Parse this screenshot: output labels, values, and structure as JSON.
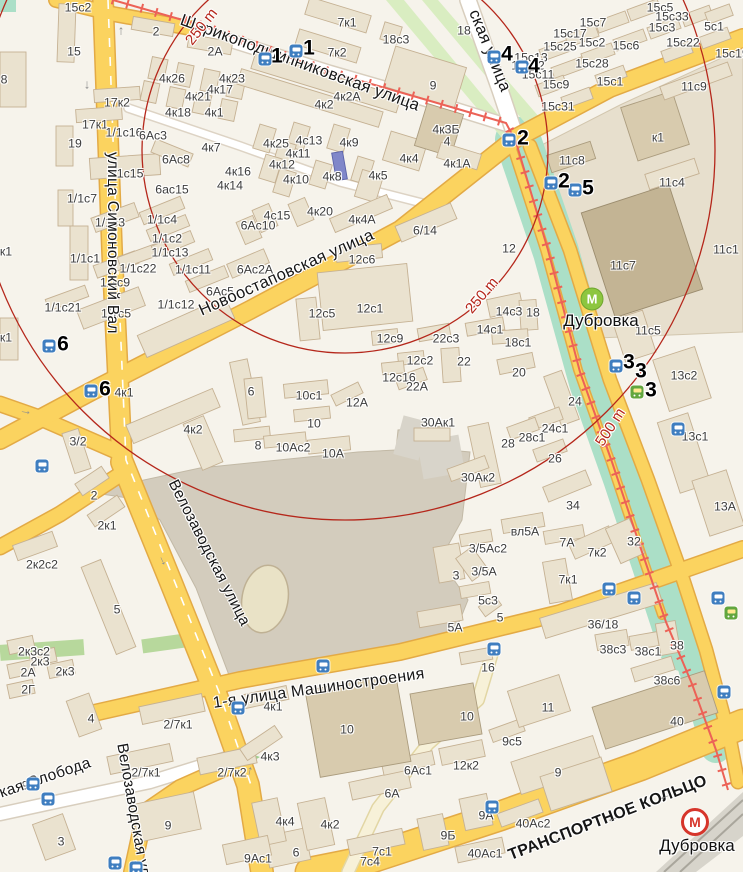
{
  "map_title": "Дубровка район — карта",
  "colors": {
    "bg": "#f6f3eb",
    "ring": "#b5271b",
    "road": "#fbd35f",
    "roadCase": "#e3aa45",
    "white": "#ffffff",
    "whiteCase": "#d8cebe",
    "green": "#abdfc7",
    "paleGreen": "#d9edc1",
    "stadium": "#d3ccbd",
    "oval": "#e9e2c6",
    "bld": "#eae2cf",
    "bldStroke": "#c5b193",
    "bldDark": "#d8cbae",
    "bldDarker": "#c3b494",
    "tram": "#ec6257",
    "bus": "#3f7ec0",
    "tramStop": "#62a63e",
    "metroGreen": "#8dc63f",
    "metroRed": "#d6352b",
    "ramp": "#f7f1d8",
    "rampCase": "#e2d6a4"
  },
  "rings": {
    "labels": [
      {
        "t": "250 m",
        "x": 182,
        "y": 38,
        "r": -52
      },
      {
        "t": "250 m",
        "x": 462,
        "y": 306,
        "r": -50
      },
      {
        "t": "500 m",
        "x": 592,
        "y": 440,
        "r": -57
      }
    ]
  },
  "streets": [
    {
      "t": "улица Симоновский Вал",
      "x": 121,
      "y": 152,
      "r": 90,
      "s": 15.5
    },
    {
      "t": "Велозаводская улица",
      "x": 180,
      "y": 477,
      "r": 63,
      "s": 15.5
    },
    {
      "t": "Велозаводская улица",
      "x": 130,
      "y": 742,
      "r": 80,
      "s": 15.5
    },
    {
      "t": "Новоостаповская улица",
      "x": 196,
      "y": 303,
      "r": -24,
      "s": 16.5
    },
    {
      "t": "Шарикоподшипниковская улица",
      "x": 184,
      "y": 11,
      "r": 20,
      "s": 16.5
    },
    {
      "t": "ская улица",
      "x": 482,
      "y": 7,
      "r": 68,
      "s": 16.5
    },
    {
      "t": "1-я улица Машиностроения",
      "x": 212,
      "y": 695,
      "r": -8,
      "s": 16
    },
    {
      "t": "Ленинская Слобода",
      "x": -54,
      "y": 803,
      "r": -19,
      "s": 15.5
    },
    {
      "t": "ТРАНСПОРТНОЕ КОЛЬЦО",
      "x": 506,
      "y": 848,
      "r": -21,
      "s": 16,
      "w": 600
    }
  ],
  "metro_stations": [
    {
      "name": "Дубровка",
      "kind": "green",
      "x": 592,
      "y": 299,
      "lx": 601,
      "ly": 311
    },
    {
      "name": "Дубровка",
      "kind": "red",
      "x": 695,
      "y": 822,
      "lx": 697,
      "ly": 836
    }
  ],
  "markers": [
    {
      "n": "1",
      "x": 277,
      "y": 57
    },
    {
      "n": "1",
      "x": 309,
      "y": 49
    },
    {
      "n": "4",
      "x": 507,
      "y": 55
    },
    {
      "n": "4",
      "x": 534,
      "y": 67
    },
    {
      "n": "2",
      "x": 523,
      "y": 139
    },
    {
      "n": "2",
      "x": 564,
      "y": 182
    },
    {
      "n": "5",
      "x": 588,
      "y": 189
    },
    {
      "n": "6",
      "x": 63,
      "y": 345
    },
    {
      "n": "6",
      "x": 105,
      "y": 390
    },
    {
      "n": "3",
      "x": 629,
      "y": 363
    },
    {
      "n": "3",
      "x": 641,
      "y": 372
    },
    {
      "n": "3",
      "x": 651,
      "y": 391
    }
  ],
  "bus_stops": [
    {
      "x": 265,
      "y": 59
    },
    {
      "x": 296,
      "y": 51
    },
    {
      "x": 494,
      "y": 57
    },
    {
      "x": 522,
      "y": 67
    },
    {
      "x": 509,
      "y": 140
    },
    {
      "x": 551,
      "y": 183
    },
    {
      "x": 575,
      "y": 190
    },
    {
      "x": 49,
      "y": 346
    },
    {
      "x": 91,
      "y": 391
    },
    {
      "x": 616,
      "y": 366
    },
    {
      "x": 678,
      "y": 429
    },
    {
      "x": 42,
      "y": 466
    },
    {
      "x": 33,
      "y": 784
    },
    {
      "x": 48,
      "y": 799
    },
    {
      "x": 115,
      "y": 863
    },
    {
      "x": 136,
      "y": 868
    },
    {
      "x": 238,
      "y": 708
    },
    {
      "x": 323,
      "y": 666
    },
    {
      "x": 494,
      "y": 649
    },
    {
      "x": 609,
      "y": 589
    },
    {
      "x": 634,
      "y": 598
    },
    {
      "x": 718,
      "y": 598
    },
    {
      "x": 724,
      "y": 692
    },
    {
      "x": 492,
      "y": 807
    }
  ],
  "tram_stops": [
    {
      "x": 637,
      "y": 392
    },
    {
      "x": 731,
      "y": 613
    }
  ],
  "road_arrows": [
    {
      "g": "↑",
      "x": 121,
      "y": 30,
      "r": 0
    },
    {
      "g": "↓",
      "x": 87,
      "y": 84,
      "r": 0
    },
    {
      "g": "↓",
      "x": 162,
      "y": 560,
      "r": -25
    },
    {
      "g": "→",
      "x": 26,
      "y": 410,
      "r": 10
    },
    {
      "g": "←",
      "x": 558,
      "y": 838,
      "r": -21
    },
    {
      "g": "←",
      "x": 612,
      "y": 817,
      "r": -21
    },
    {
      "g": "←",
      "x": 664,
      "y": 795,
      "r": -21
    },
    {
      "g": "↑",
      "x": 250,
      "y": 770,
      "r": 12
    }
  ],
  "buildings": [
    {
      "t": "15с2",
      "x": 78,
      "y": 8
    },
    {
      "t": "15",
      "x": 74,
      "y": 52
    },
    {
      "t": "2",
      "x": 156,
      "y": 32
    },
    {
      "t": "8",
      "x": 4,
      "y": 80
    },
    {
      "t": "2А",
      "x": 215,
      "y": 52
    },
    {
      "t": "4к26",
      "x": 172,
      "y": 79
    },
    {
      "t": "4к23",
      "x": 232,
      "y": 79
    },
    {
      "t": "4к17",
      "x": 220,
      "y": 90
    },
    {
      "t": "4к21",
      "x": 198,
      "y": 97
    },
    {
      "t": "4к18",
      "x": 178,
      "y": 113
    },
    {
      "t": "4к1",
      "x": 214,
      "y": 113
    },
    {
      "t": "17к2",
      "x": 117,
      "y": 103
    },
    {
      "t": "17к1",
      "x": 95,
      "y": 125
    },
    {
      "t": "1/1с16",
      "x": 124,
      "y": 133
    },
    {
      "t": "6Ас3",
      "x": 153,
      "y": 136
    },
    {
      "t": "19",
      "x": 75,
      "y": 144
    },
    {
      "t": "4к7",
      "x": 211,
      "y": 148
    },
    {
      "t": "6Ас8",
      "x": 176,
      "y": 160
    },
    {
      "t": "1/1с15",
      "x": 125,
      "y": 174
    },
    {
      "t": "6ас15",
      "x": 172,
      "y": 190
    },
    {
      "t": "4к16",
      "x": 238,
      "y": 172
    },
    {
      "t": "4к14",
      "x": 230,
      "y": 186
    },
    {
      "t": "к1",
      "x": 6,
      "y": 252
    },
    {
      "t": "к1",
      "x": 6,
      "y": 338
    },
    {
      "t": "1/1с7",
      "x": 82,
      "y": 199
    },
    {
      "t": "1/1с3",
      "x": 110,
      "y": 223
    },
    {
      "t": "1/1с4",
      "x": 162,
      "y": 220
    },
    {
      "t": "1/1с2",
      "x": 167,
      "y": 239
    },
    {
      "t": "1/1с13",
      "x": 170,
      "y": 253
    },
    {
      "t": "1/1с1",
      "x": 85,
      "y": 259
    },
    {
      "t": "1/1с22",
      "x": 138,
      "y": 269
    },
    {
      "t": "1/1с11",
      "x": 193,
      "y": 270
    },
    {
      "t": "1/1с9",
      "x": 115,
      "y": 283
    },
    {
      "t": "6Ас5",
      "x": 220,
      "y": 292
    },
    {
      "t": "1/1с21",
      "x": 63,
      "y": 308
    },
    {
      "t": "1/1с5",
      "x": 116,
      "y": 314
    },
    {
      "t": "1/1с12",
      "x": 176,
      "y": 305
    },
    {
      "t": "6",
      "x": 251,
      "y": 392
    },
    {
      "t": "3/2",
      "x": 78,
      "y": 442
    },
    {
      "t": "2",
      "x": 94,
      "y": 496
    },
    {
      "t": "2к1",
      "x": 107,
      "y": 526
    },
    {
      "t": "2к2с2",
      "x": 42,
      "y": 565
    },
    {
      "t": "5",
      "x": 117,
      "y": 610
    },
    {
      "t": "4к2",
      "x": 193,
      "y": 430
    },
    {
      "t": "7к1",
      "x": 347,
      "y": 23
    },
    {
      "t": "7к2",
      "x": 337,
      "y": 53
    },
    {
      "t": "18с3",
      "x": 396,
      "y": 40
    },
    {
      "t": "18",
      "x": 464,
      "y": 31
    },
    {
      "t": "9",
      "x": 433,
      "y": 86
    },
    {
      "t": "4к2А",
      "x": 347,
      "y": 97
    },
    {
      "t": "4к2",
      "x": 324,
      "y": 105
    },
    {
      "t": "4к25",
      "x": 276,
      "y": 144
    },
    {
      "t": "4с13",
      "x": 309,
      "y": 141
    },
    {
      "t": "4к9",
      "x": 349,
      "y": 143
    },
    {
      "t": "4к11",
      "x": 298,
      "y": 154
    },
    {
      "t": "4к12",
      "x": 282,
      "y": 165
    },
    {
      "t": "4к10",
      "x": 296,
      "y": 180
    },
    {
      "t": "4к8",
      "x": 332,
      "y": 177
    },
    {
      "t": "4к5",
      "x": 378,
      "y": 176
    },
    {
      "t": "4к4",
      "x": 409,
      "y": 159
    },
    {
      "t": "4к3Б",
      "x": 446,
      "y": 130
    },
    {
      "t": "4",
      "x": 447,
      "y": 142
    },
    {
      "t": "4к1А",
      "x": 457,
      "y": 164
    },
    {
      "t": "4к20",
      "x": 320,
      "y": 212
    },
    {
      "t": "4с15",
      "x": 277,
      "y": 216
    },
    {
      "t": "6Ас10",
      "x": 258,
      "y": 226
    },
    {
      "t": "6Ас2А",
      "x": 255,
      "y": 270
    },
    {
      "t": "4к4А",
      "x": 362,
      "y": 220
    },
    {
      "t": "6/14",
      "x": 425,
      "y": 231
    },
    {
      "t": "12с6",
      "x": 362,
      "y": 260
    },
    {
      "t": "12с1",
      "x": 370,
      "y": 309
    },
    {
      "t": "12с5",
      "x": 322,
      "y": 314
    },
    {
      "t": "12с9",
      "x": 390,
      "y": 339
    },
    {
      "t": "22с3",
      "x": 446,
      "y": 339
    },
    {
      "t": "12с2",
      "x": 420,
      "y": 361
    },
    {
      "t": "22",
      "x": 464,
      "y": 362
    },
    {
      "t": "12с16",
      "x": 399,
      "y": 378
    },
    {
      "t": "22А",
      "x": 417,
      "y": 387
    },
    {
      "t": "12",
      "x": 509,
      "y": 249
    },
    {
      "t": "14с3",
      "x": 509,
      "y": 312
    },
    {
      "t": "14с1",
      "x": 490,
      "y": 330
    },
    {
      "t": "18",
      "x": 533,
      "y": 313
    },
    {
      "t": "18с1",
      "x": 518,
      "y": 343
    },
    {
      "t": "20",
      "x": 519,
      "y": 373
    },
    {
      "t": "24",
      "x": 575,
      "y": 402
    },
    {
      "t": "24с1",
      "x": 555,
      "y": 429
    },
    {
      "t": "28с1",
      "x": 532,
      "y": 438
    },
    {
      "t": "28",
      "x": 508,
      "y": 444
    },
    {
      "t": "26",
      "x": 555,
      "y": 459
    },
    {
      "t": "34",
      "x": 573,
      "y": 506
    },
    {
      "t": "30Ак1",
      "x": 438,
      "y": 423
    },
    {
      "t": "30Ак2",
      "x": 478,
      "y": 478
    },
    {
      "t": "10с1",
      "x": 309,
      "y": 396
    },
    {
      "t": "12А",
      "x": 357,
      "y": 403
    },
    {
      "t": "10",
      "x": 314,
      "y": 424
    },
    {
      "t": "8",
      "x": 258,
      "y": 446
    },
    {
      "t": "10Ас2",
      "x": 293,
      "y": 448
    },
    {
      "t": "10А",
      "x": 333,
      "y": 454
    },
    {
      "t": "15с5",
      "x": 660,
      "y": 8
    },
    {
      "t": "15с33",
      "x": 672,
      "y": 17
    },
    {
      "t": "15с3",
      "x": 662,
      "y": 28
    },
    {
      "t": "5с1",
      "x": 714,
      "y": 27
    },
    {
      "t": "15с22",
      "x": 683,
      "y": 43
    },
    {
      "t": "15с6",
      "x": 626,
      "y": 46
    },
    {
      "t": "15с7",
      "x": 593,
      "y": 23
    },
    {
      "t": "15с17",
      "x": 570,
      "y": 34
    },
    {
      "t": "15с2",
      "x": 592,
      "y": 43
    },
    {
      "t": "15с25",
      "x": 560,
      "y": 47
    },
    {
      "t": "15с13",
      "x": 531,
      "y": 58
    },
    {
      "t": "15с12",
      "x": 528,
      "y": 66
    },
    {
      "t": "15с28",
      "x": 592,
      "y": 64
    },
    {
      "t": "15с11",
      "x": 538,
      "y": 75
    },
    {
      "t": "15с9",
      "x": 556,
      "y": 85
    },
    {
      "t": "15с1",
      "x": 610,
      "y": 82
    },
    {
      "t": "15с31",
      "x": 558,
      "y": 107
    },
    {
      "t": "15с19",
      "x": 732,
      "y": 54
    },
    {
      "t": "11с9",
      "x": 694,
      "y": 87
    },
    {
      "t": "к1",
      "x": 658,
      "y": 138
    },
    {
      "t": "11с8",
      "x": 572,
      "y": 161
    },
    {
      "t": "11с4",
      "x": 672,
      "y": 183
    },
    {
      "t": "11с7",
      "x": 623,
      "y": 266
    },
    {
      "t": "11с1",
      "x": 726,
      "y": 250
    },
    {
      "t": "11с5",
      "x": 648,
      "y": 331
    },
    {
      "t": "13с2",
      "x": 684,
      "y": 376
    },
    {
      "t": "13с1",
      "x": 695,
      "y": 437
    },
    {
      "t": "13А",
      "x": 725,
      "y": 507
    },
    {
      "t": "вл5А",
      "x": 525,
      "y": 532
    },
    {
      "t": "7А",
      "x": 567,
      "y": 543
    },
    {
      "t": "7к2",
      "x": 597,
      "y": 553
    },
    {
      "t": "7к1",
      "x": 568,
      "y": 580
    },
    {
      "t": "32",
      "x": 634,
      "y": 542
    },
    {
      "t": "3/5Ас2",
      "x": 488,
      "y": 549
    },
    {
      "t": "3",
      "x": 456,
      "y": 576
    },
    {
      "t": "3/5А",
      "x": 484,
      "y": 572
    },
    {
      "t": "5с3",
      "x": 488,
      "y": 601
    },
    {
      "t": "5",
      "x": 500,
      "y": 618
    },
    {
      "t": "5А",
      "x": 455,
      "y": 628
    },
    {
      "t": "36/18",
      "x": 603,
      "y": 625
    },
    {
      "t": "38с3",
      "x": 613,
      "y": 650
    },
    {
      "t": "38с1",
      "x": 648,
      "y": 652
    },
    {
      "t": "38",
      "x": 677,
      "y": 646
    },
    {
      "t": "38с6",
      "x": 667,
      "y": 681
    },
    {
      "t": "16",
      "x": 488,
      "y": 668
    },
    {
      "t": "2к3с2",
      "x": 34,
      "y": 652
    },
    {
      "t": "2к3",
      "x": 40,
      "y": 662
    },
    {
      "t": "2А",
      "x": 28,
      "y": 673
    },
    {
      "t": "2к3",
      "x": 65,
      "y": 672
    },
    {
      "t": "2Г",
      "x": 28,
      "y": 690
    },
    {
      "t": "4",
      "x": 91,
      "y": 719
    },
    {
      "t": "9",
      "x": 25,
      "y": 786
    },
    {
      "t": "3",
      "x": 61,
      "y": 842
    },
    {
      "t": "6",
      "x": 296,
      "y": 853
    },
    {
      "t": "9",
      "x": 168,
      "y": 826
    },
    {
      "t": "2/7к1",
      "x": 178,
      "y": 725
    },
    {
      "t": "2/7к1",
      "x": 146,
      "y": 773
    },
    {
      "t": "2/7к2",
      "x": 232,
      "y": 773
    },
    {
      "t": "4к1",
      "x": 273,
      "y": 707
    },
    {
      "t": "10",
      "x": 347,
      "y": 730
    },
    {
      "t": "4к3",
      "x": 270,
      "y": 757
    },
    {
      "t": "6Ас1",
      "x": 418,
      "y": 771
    },
    {
      "t": "12к2",
      "x": 466,
      "y": 766
    },
    {
      "t": "6А",
      "x": 392,
      "y": 794
    },
    {
      "t": "4к4",
      "x": 285,
      "y": 822
    },
    {
      "t": "4к2",
      "x": 330,
      "y": 825
    },
    {
      "t": "9Ас1",
      "x": 258,
      "y": 859
    },
    {
      "t": "7с1",
      "x": 382,
      "y": 852
    },
    {
      "t": "7с4",
      "x": 370,
      "y": 862
    },
    {
      "t": "9Б",
      "x": 448,
      "y": 836
    },
    {
      "t": "9А",
      "x": 486,
      "y": 816
    },
    {
      "t": "40Ас1",
      "x": 485,
      "y": 854
    },
    {
      "t": "40Ас2",
      "x": 533,
      "y": 824
    },
    {
      "t": "9с5",
      "x": 512,
      "y": 742
    },
    {
      "t": "11",
      "x": 548,
      "y": 708
    },
    {
      "t": "9",
      "x": 558,
      "y": 773
    },
    {
      "t": "40",
      "x": 677,
      "y": 722
    },
    {
      "t": "10",
      "x": 467,
      "y": 717
    },
    {
      "t": "4к1",
      "x": 124,
      "y": 393
    }
  ]
}
